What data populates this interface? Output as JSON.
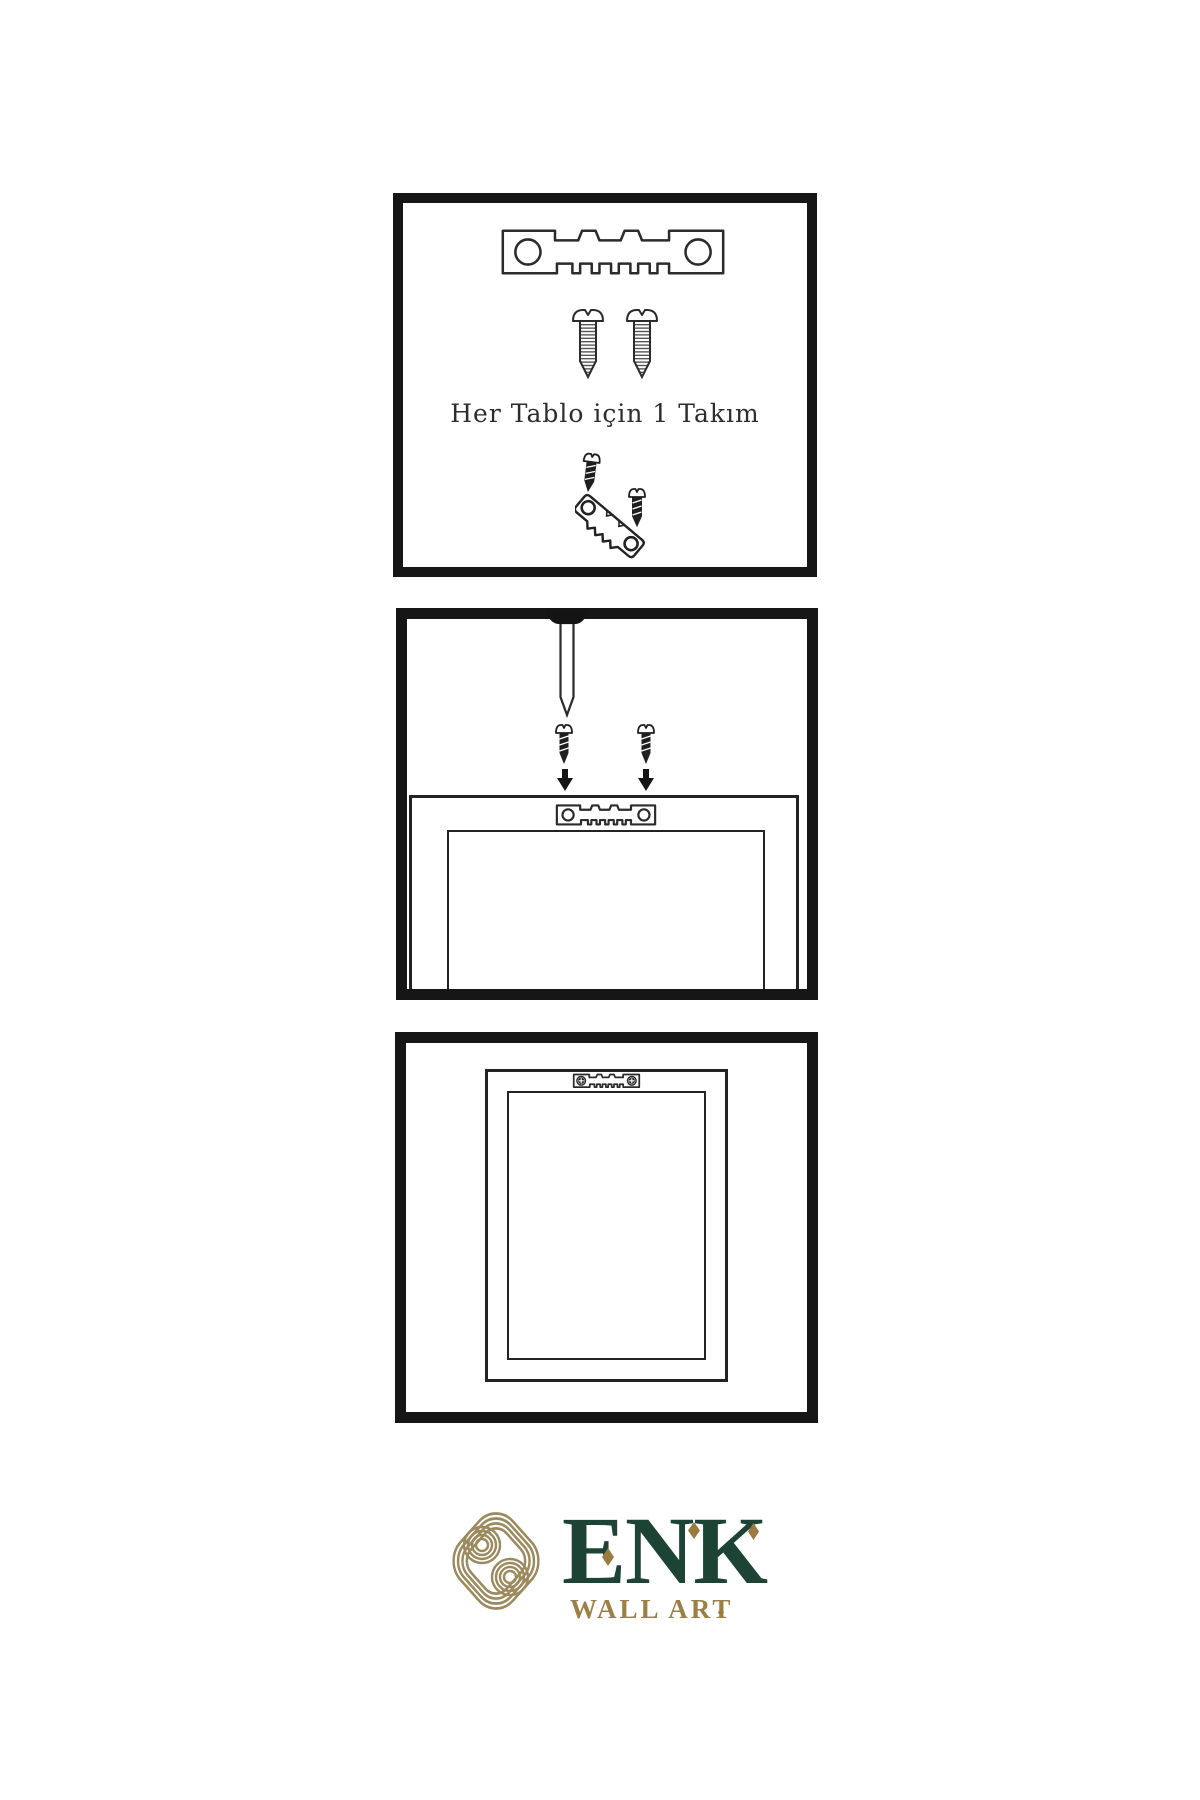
{
  "step1": {
    "caption": "Her Tablo için 1 Takım",
    "icons": [
      "sawtooth-hanger-icon",
      "screw-icon",
      "screw-icon",
      "screw-dark-icon",
      "tilted-sawtooth-hanger-icon",
      "screw-dark-icon"
    ]
  },
  "step2": {
    "icons": [
      "nail-icon",
      "screw-dark-icon",
      "screw-dark-icon",
      "arrow-down-icon",
      "arrow-down-icon",
      "sawtooth-hanger-icon",
      "picture-frame"
    ]
  },
  "step3": {
    "icons": [
      "sawtooth-hanger-screwed-icon",
      "picture-frame"
    ]
  },
  "brand": {
    "name": "ENK",
    "tagline": "WALL ART",
    "logomark": "interwoven-knot-icon",
    "colors": {
      "green": "#1d4335",
      "gold": "#9c7f45",
      "knot_gold": "#9c8a5e",
      "ink": "#161616"
    }
  }
}
